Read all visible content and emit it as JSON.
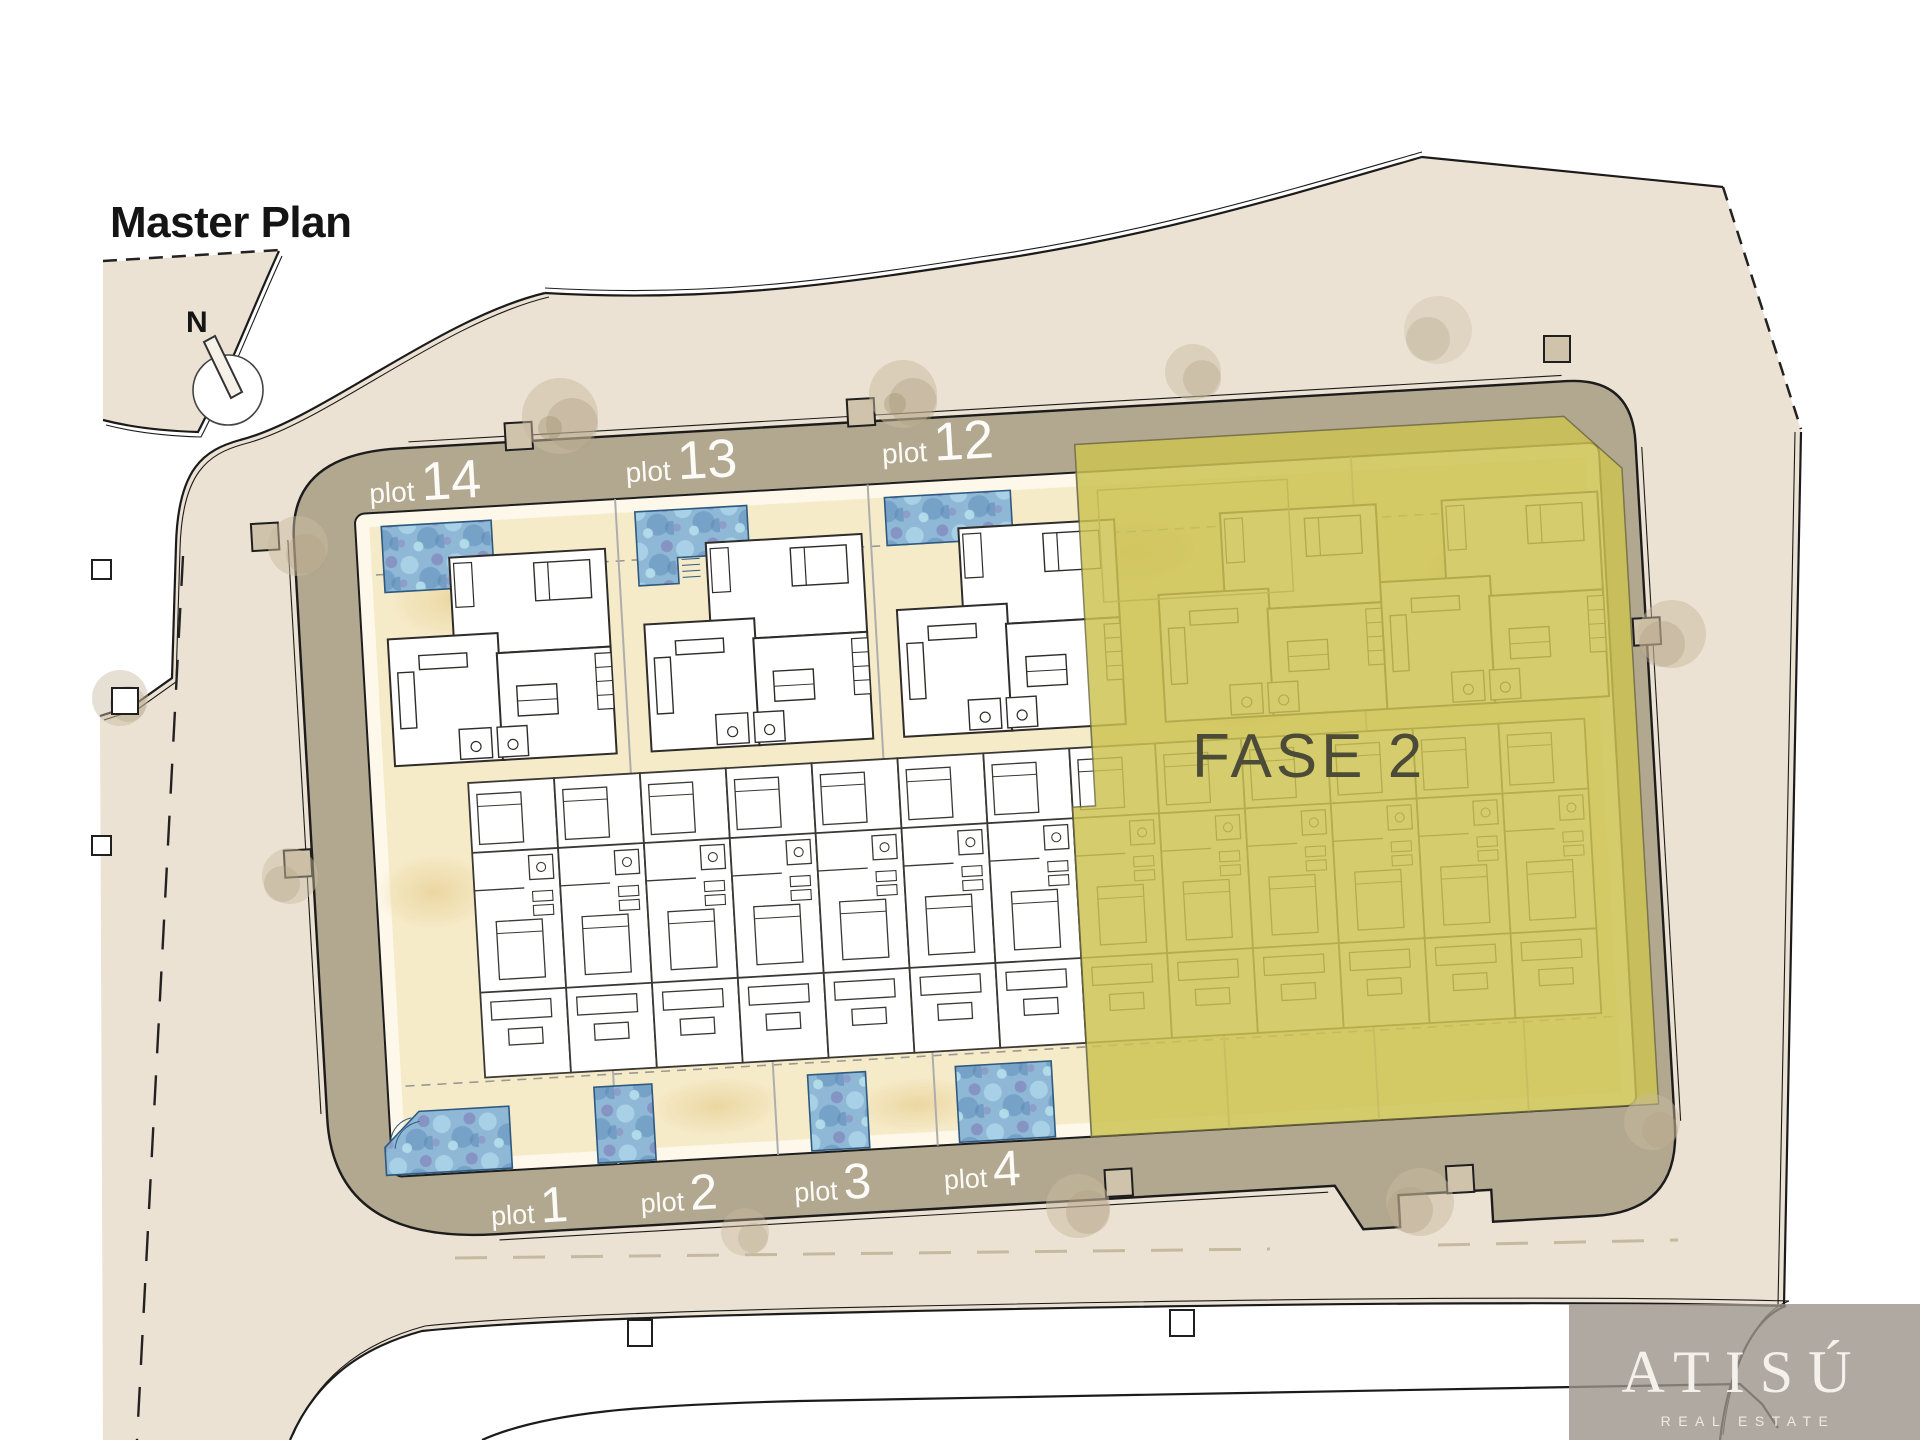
{
  "title": "Master Plan",
  "compass": {
    "label": "N"
  },
  "phase": {
    "label": "FASE 2"
  },
  "plots": {
    "top": [
      {
        "word": "plot",
        "num": "14"
      },
      {
        "word": "plot",
        "num": "13"
      },
      {
        "word": "plot",
        "num": "12"
      }
    ],
    "bottom": [
      {
        "word": "plot",
        "num": "1"
      },
      {
        "word": "plot",
        "num": "2"
      },
      {
        "word": "plot",
        "num": "3"
      },
      {
        "word": "plot",
        "num": "4"
      }
    ]
  },
  "logo": {
    "brand": "ATISÚ",
    "tagline": "REAL ESTATE"
  },
  "colors": {
    "site_beige": "#ece2d3",
    "road_band_tan": "#b2a890",
    "plot_sand": "#f6ebc9",
    "inner_white": "#fdf8ea",
    "phase2_yellow": "#cdc353",
    "pool_blue": "#8fb8d6",
    "phase2_text": "#4c4b37",
    "plot_label_white": "#fcfbf7",
    "title_black": "#141414"
  }
}
